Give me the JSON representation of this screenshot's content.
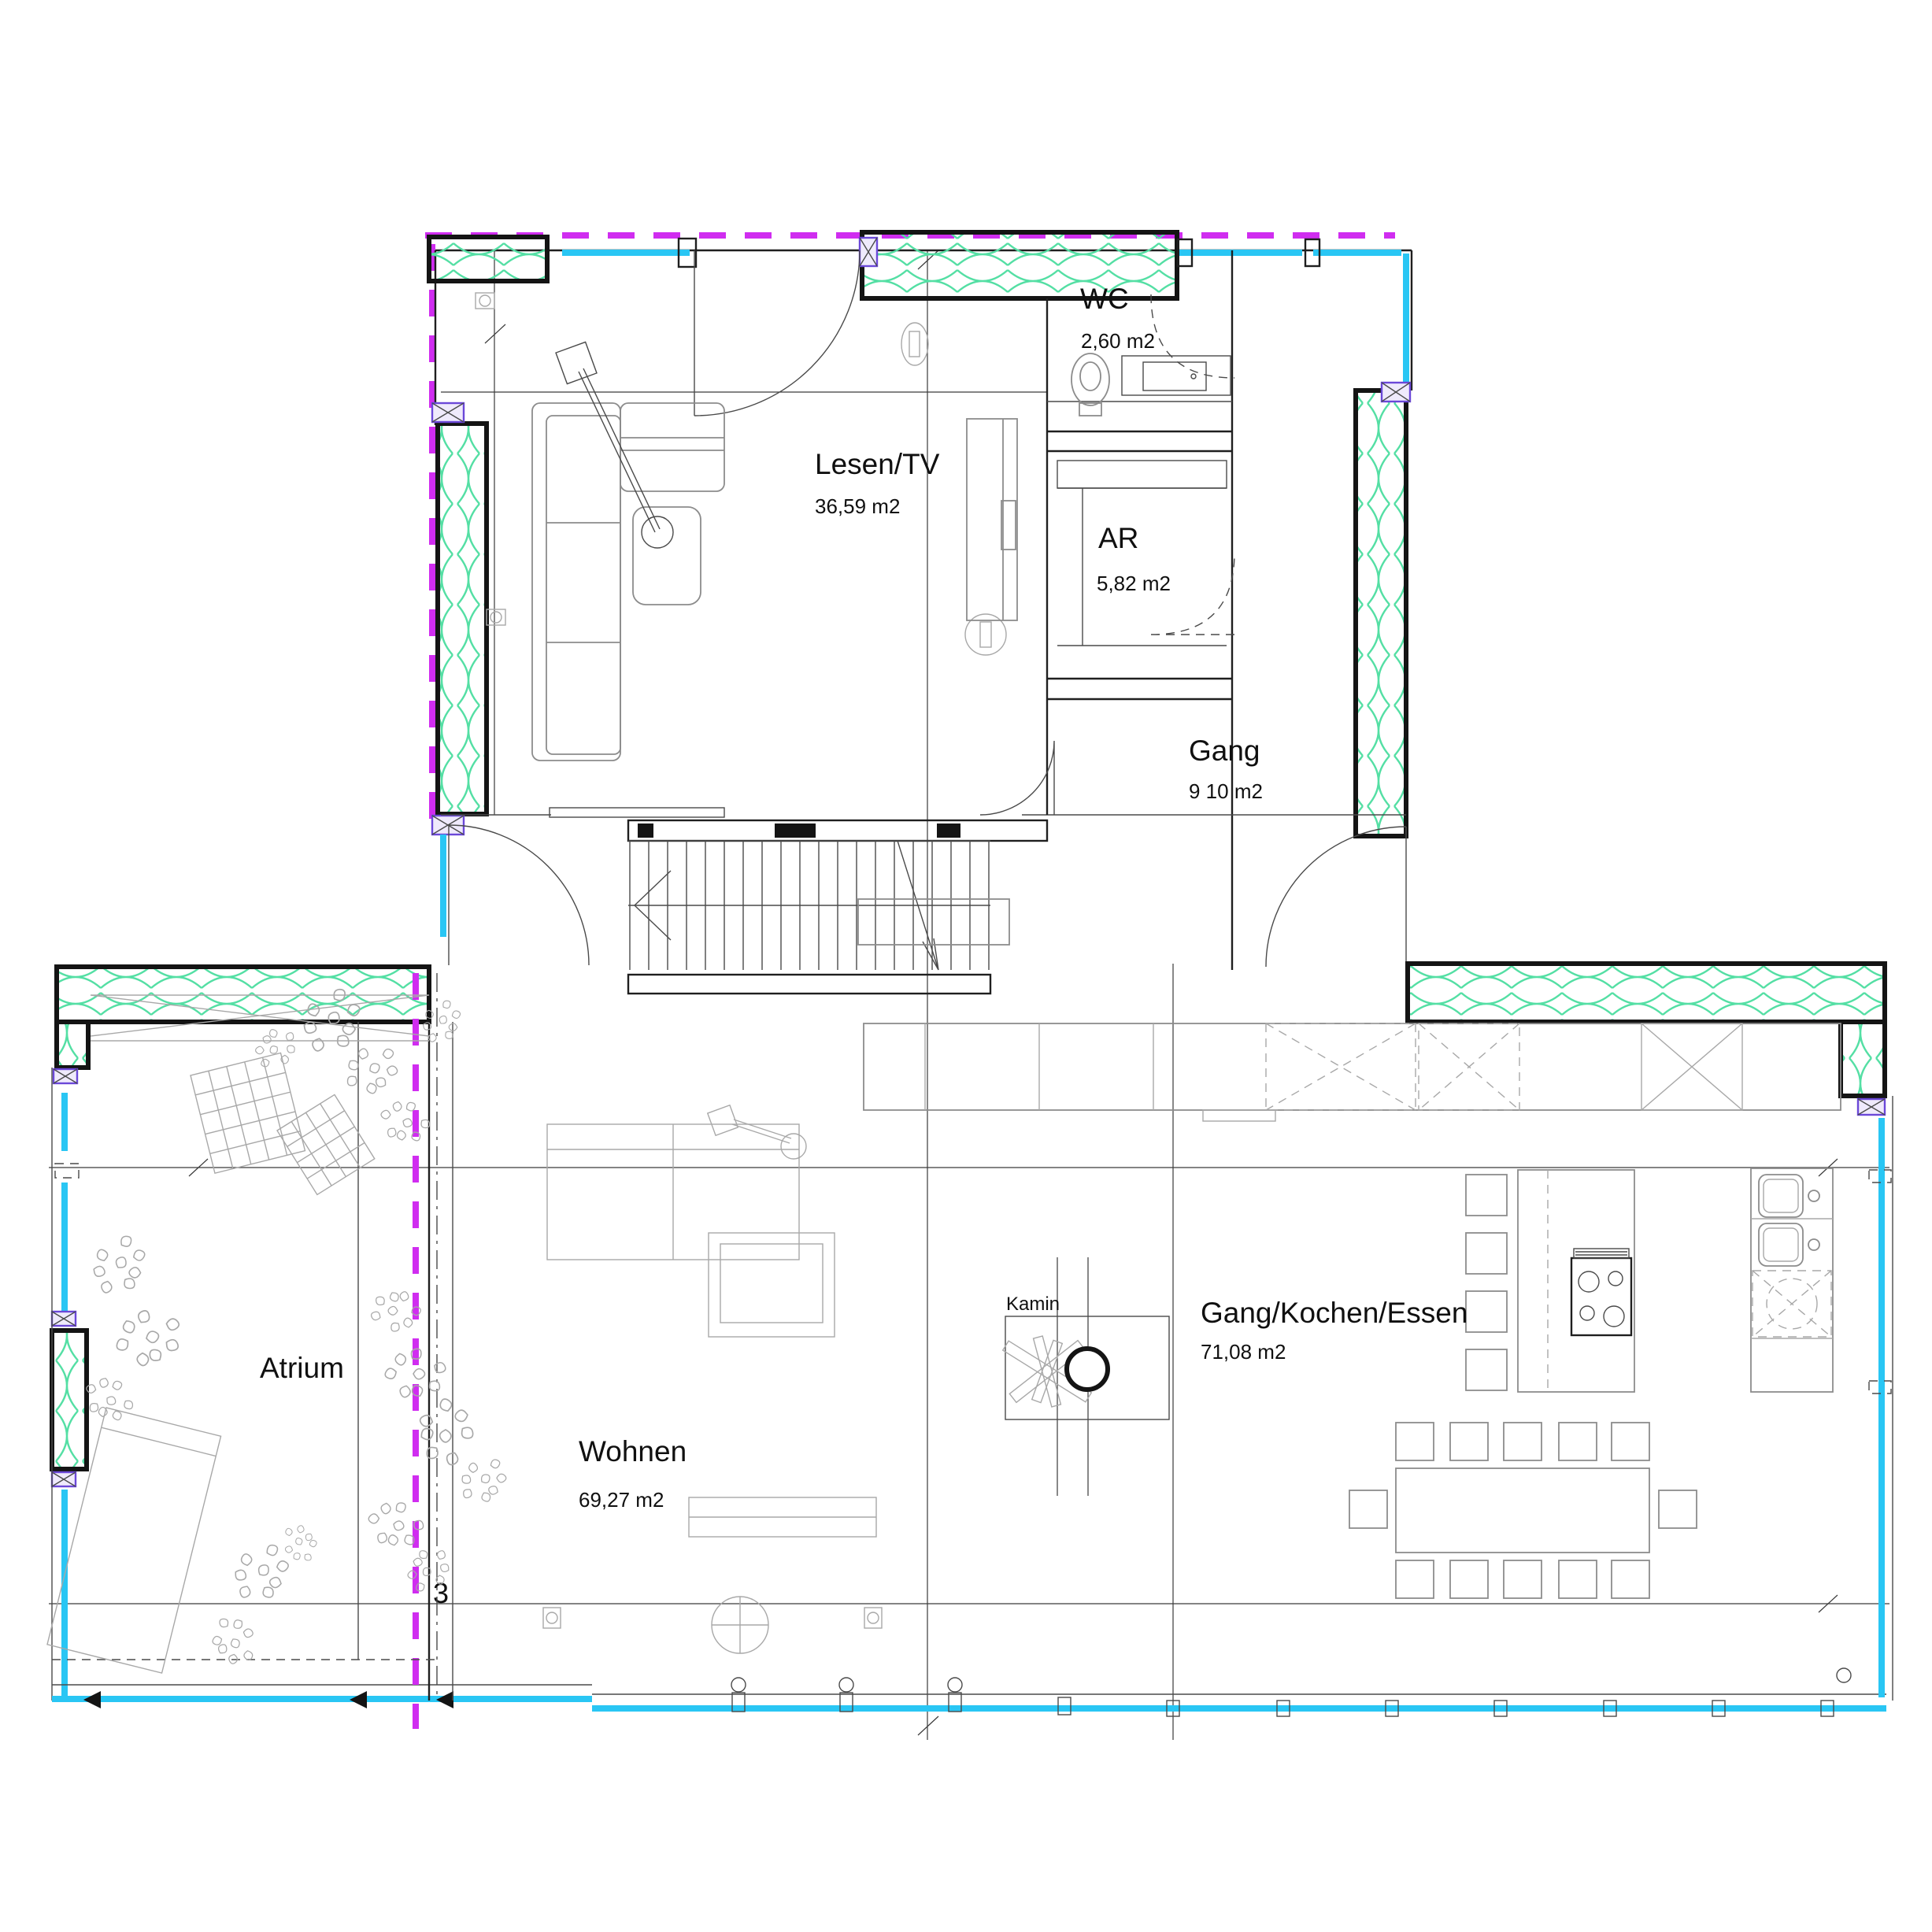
{
  "rooms": {
    "wc": {
      "label": "WC",
      "area": "2,60 m2"
    },
    "lesen_tv": {
      "label": "Lesen/TV",
      "area": "36,59 m2"
    },
    "ar": {
      "label": "AR",
      "area": "5,82 m2"
    },
    "gang": {
      "label": "Gang",
      "area": "9 10 m2"
    },
    "atrium": {
      "label": "Atrium"
    },
    "wohnen": {
      "label": "Wohnen",
      "area": "69,27 m2"
    },
    "kamin": {
      "label": "Kamin"
    },
    "gang_kochen_essen": {
      "label": "Gang/Kochen/Essen",
      "area": "71,08 m2"
    }
  },
  "markers": {
    "axis_number": "3"
  },
  "colors": {
    "glazing": "#29c6f4",
    "roof_projection": "#d02df0",
    "insulation": "#54dfa4",
    "window_symbol": "#6b48d8",
    "wall": "#141414",
    "furniture": "#8c8c8c"
  }
}
